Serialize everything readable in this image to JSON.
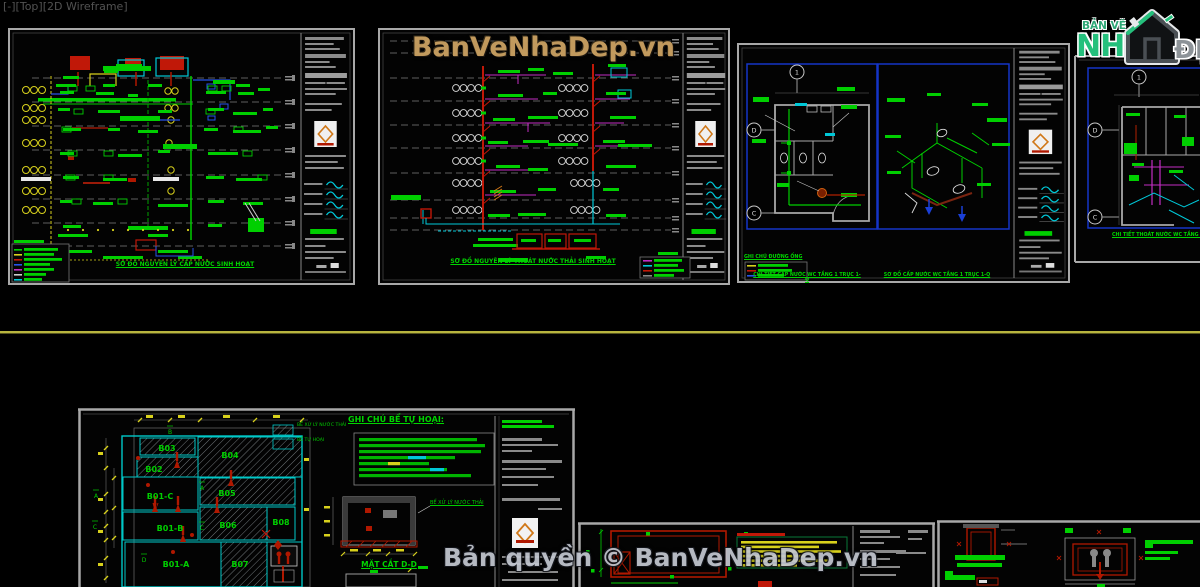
{
  "viewport": {
    "label": "[-][Top][2D Wireframe]"
  },
  "watermarks": {
    "top": "BanVeNhaDep.vn",
    "bottom": "Bản quyền © BanVeNhaDep.vn"
  },
  "brand": {
    "tagline": "BẢN VẼ",
    "name_prefix": "NH",
    "name_suffix": "ĐẸP"
  },
  "sheet1": {
    "title": "SƠ ĐỒ NGUYÊN LÝ CẤP NƯỚC SINH HOẠT",
    "legend_title": "GHI CHÚ ĐƯỜNG ỐNG"
  },
  "sheet2": {
    "title": "SƠ ĐỒ NGUYÊN LÝ THOÁT NƯỚC THẢI SINH HOẠT"
  },
  "sheet3": {
    "left_title": "CHI TIẾT CẤP NƯỚC WC TẦNG 1 TRỤC 1-Q",
    "right_title": "SƠ ĐỒ CẤP NƯỚC WC TẦNG 1 TRỤC 1-Q",
    "legend_title": "GHI CHÚ ĐƯỜNG ỐNG",
    "bubbles": {
      "one": "1",
      "d": "D",
      "c": "C"
    }
  },
  "sheet4": {
    "title": "CHI TIẾT THOÁT NƯỚC WC TẦNG 1 TRỤC 1-Q",
    "bubbles": {
      "one": "1",
      "d": "D",
      "c": "C"
    }
  },
  "septic": {
    "notes_title": "GHI CHÚ BỂ TỰ HOẠI:",
    "legend_hatched": "BỂ XỬ LÝ NƯỚC THẢI",
    "legend_plain": "BỂ TỰ HOẠI",
    "section_title": "MẶT CẮT D-D",
    "tank_callout": "BỂ XỬ LÝ NƯỚC THẢI",
    "rooms": {
      "b01a": "B01-A",
      "b01b": "B01-B",
      "b01c": "B01-C",
      "b02": "B02",
      "b03": "B03",
      "b04": "B04",
      "b05": "B05",
      "b06": "B06",
      "b07": "B07",
      "b08": "B08"
    },
    "grid": {
      "a": "A",
      "b": "B",
      "c": "C",
      "d": "D"
    }
  }
}
